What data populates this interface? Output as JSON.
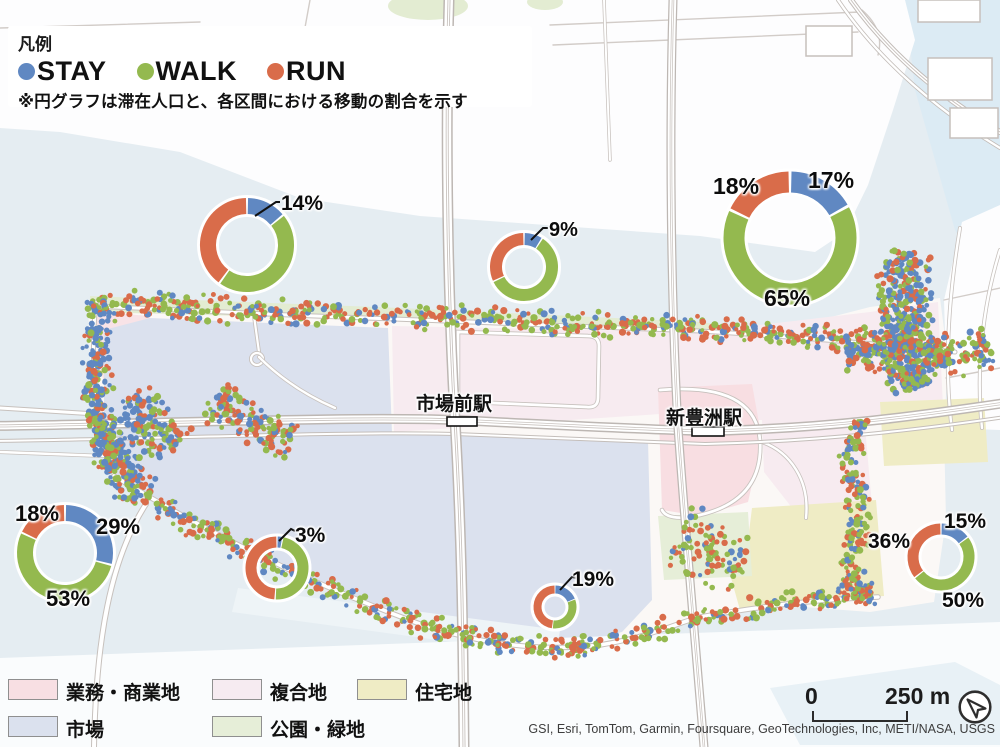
{
  "palette": {
    "stay": "#6088c2",
    "walk": "#94b94f",
    "run": "#d96c4a"
  },
  "legend": {
    "title": "凡例",
    "items": [
      {
        "label": "STAY",
        "key": "stay"
      },
      {
        "label": "WALK",
        "key": "walk"
      },
      {
        "label": "RUN",
        "key": "run"
      }
    ],
    "note": "※円グラフは滞在人口と、各区間における移動の割合を示す"
  },
  "stations": [
    {
      "name": "市場前駅"
    },
    {
      "name": "新豊洲駅"
    }
  ],
  "landuse": {
    "items": [
      {
        "label": "業務・商業地",
        "color": "#f8dfe3"
      },
      {
        "label": "複合地",
        "color": "#f6ebf1"
      },
      {
        "label": "住宅地",
        "color": "#efecc5"
      },
      {
        "label": "市場",
        "color": "#dbe1ee"
      },
      {
        "label": "公園・緑地",
        "color": "#e6eed8"
      }
    ]
  },
  "scalebar": {
    "start": "0",
    "end": "250 m"
  },
  "attribution": "GSI, Esri, TomTom, Garmin, Foursquare, GeoTechnologies, Inc, METI/NASA, USGS",
  "chart_data": [
    {
      "type": "donut",
      "id": "northwest",
      "cx": 247,
      "cy": 245,
      "r": 39,
      "thick": 16,
      "series": [
        "STAY",
        "WALK",
        "RUN"
      ],
      "values": [
        14,
        46,
        40
      ],
      "labels": [
        {
          "text": "14%",
          "x": 281,
          "y": 192,
          "fs": 21,
          "leader": [
            [
              255,
              216
            ],
            [
              276,
              202
            ],
            [
              280,
              202
            ]
          ]
        }
      ]
    },
    {
      "type": "donut",
      "id": "north-center",
      "cx": 524,
      "cy": 267,
      "r": 28,
      "thick": 12,
      "series": [
        "STAY",
        "WALK",
        "RUN"
      ],
      "values": [
        9,
        59,
        32
      ],
      "labels": [
        {
          "text": "9%",
          "x": 549,
          "y": 219,
          "fs": 20,
          "leader": [
            [
              531,
              240
            ],
            [
              543,
              228
            ],
            [
              548,
              228
            ]
          ]
        }
      ]
    },
    {
      "type": "donut",
      "id": "northeast",
      "cx": 790,
      "cy": 238,
      "r": 56,
      "thick": 21,
      "series": [
        "STAY",
        "WALK",
        "RUN"
      ],
      "values": [
        17,
        65,
        18
      ],
      "labels": [
        {
          "text": "17%",
          "x": 808,
          "y": 167,
          "fs": 23
        },
        {
          "text": "18%",
          "x": 713,
          "y": 173,
          "fs": 23
        },
        {
          "text": "65%",
          "x": 764,
          "y": 285,
          "fs": 23
        }
      ]
    },
    {
      "type": "donut",
      "id": "west",
      "cx": 65,
      "cy": 553,
      "r": 40,
      "thick": 16,
      "series": [
        "STAY",
        "WALK",
        "RUN"
      ],
      "values": [
        29,
        53,
        18
      ],
      "labels": [
        {
          "text": "29%",
          "x": 96,
          "y": 514,
          "fs": 22
        },
        {
          "text": "18%",
          "x": 15,
          "y": 501,
          "fs": 22
        },
        {
          "text": "53%",
          "x": 46,
          "y": 586,
          "fs": 22
        }
      ]
    },
    {
      "type": "donut",
      "id": "south-center-west",
      "cx": 277,
      "cy": 568,
      "r": 26,
      "thick": 11,
      "series": [
        "STAY",
        "WALK",
        "RUN"
      ],
      "values": [
        3,
        48,
        49
      ],
      "labels": [
        {
          "text": "3%",
          "x": 295,
          "y": 524,
          "fs": 21,
          "leader": [
            [
              279,
              541
            ],
            [
              291,
              529
            ],
            [
              295,
              531
            ]
          ]
        }
      ]
    },
    {
      "type": "donut",
      "id": "south-center",
      "cx": 555,
      "cy": 607,
      "r": 17.5,
      "thick": 8,
      "series": [
        "STAY",
        "WALK",
        "RUN"
      ],
      "values": [
        19,
        33,
        48
      ],
      "labels": [
        {
          "text": "19%",
          "x": 572,
          "y": 568,
          "fs": 21,
          "leader": [
            [
              560,
              590
            ],
            [
              572,
              577
            ],
            [
              577,
              578
            ]
          ]
        }
      ]
    },
    {
      "type": "donut",
      "id": "east",
      "cx": 941,
      "cy": 557,
      "r": 28,
      "thick": 11,
      "series": [
        "STAY",
        "WALK",
        "RUN"
      ],
      "values": [
        15,
        50,
        36
      ],
      "labels": [
        {
          "text": "15%",
          "x": 944,
          "y": 510,
          "fs": 21
        },
        {
          "text": "36%",
          "x": 868,
          "y": 530,
          "fs": 21
        },
        {
          "text": "50%",
          "x": 942,
          "y": 589,
          "fs": 21
        }
      ]
    }
  ],
  "map_dots": {
    "bands": [
      {
        "pts": [
          [
            95,
            303
          ],
          [
            300,
            312
          ],
          [
            500,
            320
          ],
          [
            700,
            329
          ],
          [
            800,
            336
          ],
          [
            950,
            350
          ]
        ],
        "w": 15,
        "n": 640,
        "mix": "std"
      },
      {
        "pts": [
          [
            102,
            303
          ],
          [
            96,
            360
          ],
          [
            100,
            420
          ],
          [
            112,
            470
          ]
        ],
        "w": 17,
        "n": 270,
        "mix": "blue"
      },
      {
        "pts": [
          [
            110,
            432
          ],
          [
            122,
            468
          ],
          [
            138,
            494
          ]
        ],
        "w": 24,
        "n": 150,
        "mix": "blue"
      },
      {
        "pts": [
          [
            130,
            398
          ],
          [
            152,
            428
          ],
          [
            175,
            448
          ]
        ],
        "w": 26,
        "n": 140,
        "mix": "blue"
      },
      {
        "pts": [
          [
            212,
            398
          ],
          [
            250,
            424
          ],
          [
            292,
            440
          ]
        ],
        "w": 24,
        "n": 140,
        "mix": "std"
      },
      {
        "pts": [
          [
            116,
            480
          ],
          [
            200,
            528
          ],
          [
            300,
            578
          ],
          [
            400,
            618
          ],
          [
            470,
            638
          ],
          [
            556,
            650
          ]
        ],
        "w": 13,
        "n": 330,
        "mix": "std"
      },
      {
        "pts": [
          [
            558,
            649
          ],
          [
            640,
            635
          ],
          [
            700,
            616
          ],
          [
            790,
            602
          ],
          [
            874,
            596
          ]
        ],
        "w": 12,
        "n": 220,
        "mix": "std"
      },
      {
        "pts": [
          [
            907,
            253
          ],
          [
            901,
            300
          ],
          [
            907,
            345
          ],
          [
            917,
            388
          ]
        ],
        "w": 30,
        "n": 430,
        "mix": "blue"
      },
      {
        "pts": [
          [
            845,
            349
          ],
          [
            900,
            356
          ],
          [
            958,
            356
          ],
          [
            990,
            349
          ]
        ],
        "w": 24,
        "n": 230,
        "mix": "mid"
      },
      {
        "pts": [
          [
            855,
            420
          ],
          [
            849,
            465
          ],
          [
            861,
            520
          ],
          [
            847,
            570
          ],
          [
            867,
            597
          ]
        ],
        "w": 14,
        "n": 200,
        "mix": "std"
      },
      {
        "pts": [
          [
            678,
            534
          ],
          [
            714,
            552
          ],
          [
            746,
            572
          ]
        ],
        "w": 36,
        "n": 100,
        "mix": "std"
      }
    ],
    "mixes": {
      "std": [
        0.2,
        0.42,
        0.38
      ],
      "blue": [
        0.5,
        0.27,
        0.23
      ],
      "mid": [
        0.33,
        0.37,
        0.3
      ]
    }
  }
}
